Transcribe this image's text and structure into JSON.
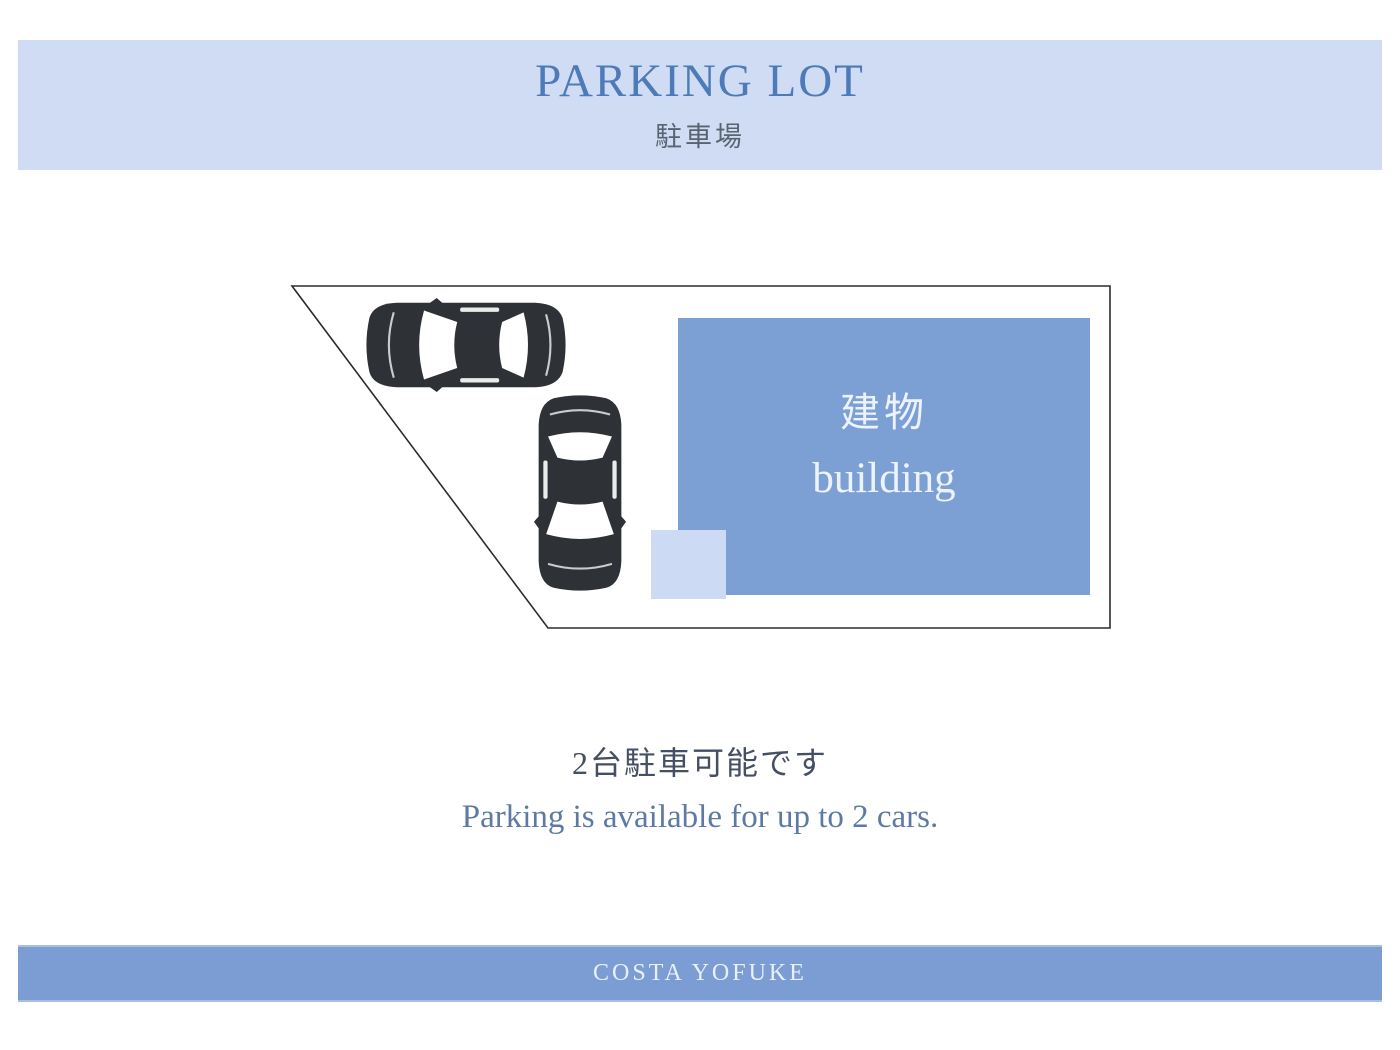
{
  "header": {
    "title": "PARKING LOT",
    "subtitle_jp": "駐車場"
  },
  "diagram": {
    "building_label_jp": "建物",
    "building_label_en": "building",
    "car_icons": [
      "car-top-view-icon",
      "car-top-view-icon"
    ],
    "car_count": 2
  },
  "caption": {
    "line_jp": "2台駐車可能です",
    "line_en": "Parking is available for up to 2 cars."
  },
  "footer": {
    "brand": "COSTA YOFUKE"
  },
  "colors": {
    "page_bg": "#ffffff",
    "band_light": "#cfdcf3",
    "band_blue": "#7b9dd3",
    "building_blue": "#7da0d4",
    "light_square": "#ccdbf3",
    "title_blue": "#4d7ab8",
    "subtitle_gray": "#596472",
    "caption_dark": "#454f63",
    "caption_blue": "#5d7aa4",
    "building_text": "#edf3fc",
    "footer_text": "#e9f0fb",
    "outline_dark": "#2b2b2b",
    "car_dark": "#2e3236"
  }
}
